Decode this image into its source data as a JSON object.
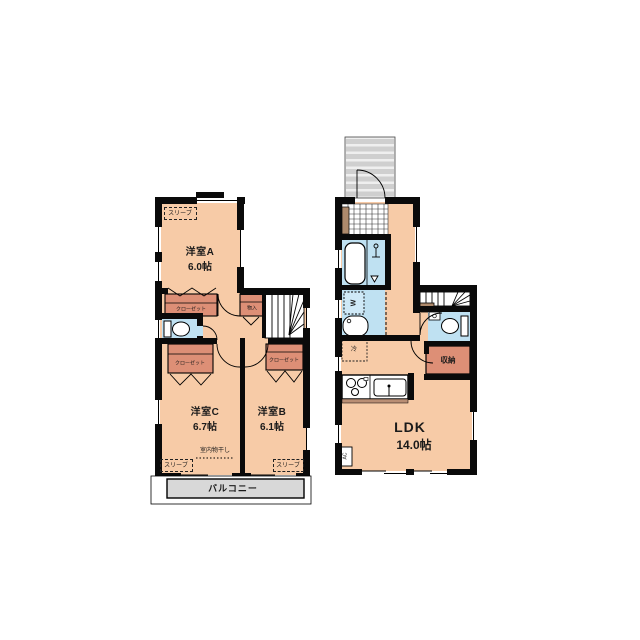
{
  "floorplan": {
    "floor2": {
      "room_a": {
        "name": "洋室A",
        "size": "6.0帖"
      },
      "room_b": {
        "name": "洋室B",
        "size": "6.1帖"
      },
      "room_c": {
        "name": "洋室C",
        "size": "6.7帖"
      },
      "closet_label": "クローゼット",
      "small_storage_label": "物入",
      "sleeve_label": "スリーブ",
      "indoor_drying_label": "室内物干し",
      "balcony_label": "バルコニー"
    },
    "floor1": {
      "ldk": {
        "name": "LDK",
        "size": "14.0帖"
      },
      "storage_label": "収納",
      "fridge_label": "冷",
      "washer_label": "W",
      "ac_label": "AC"
    },
    "colors": {
      "room_fill": "#F7CBA7",
      "closet_fill": "#DD8F76",
      "wet_area_fill": "#BFE1F2",
      "gray_fill": "#D8D8D8",
      "wall": "#0a0a0a",
      "wood_accent": "#AE8A6C"
    }
  }
}
